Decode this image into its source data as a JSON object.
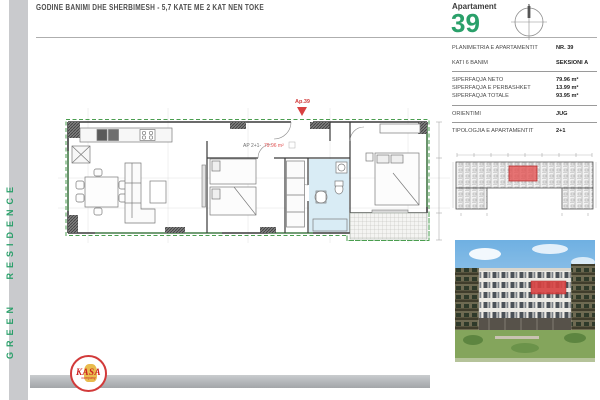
{
  "header": {
    "title": "GODINE BANIMI DHE SHERBIMESH - 5,7 KATE ME 2 KAT NEN TOKE"
  },
  "sidebar": {
    "brand": "GREEN RESIDENCE"
  },
  "apartment_card": {
    "label": "Apartament",
    "number": "39",
    "compass_north": "N"
  },
  "info_panel": {
    "rows": [
      {
        "label": "PLANIMETRIA E APARTAMENTIT",
        "value": "NR. 39"
      },
      {
        "label": "KATI 6 BANIM",
        "value": "SEKSIONI A"
      }
    ],
    "areas": [
      {
        "label": "SIPERFAQJA NETO",
        "value": "79.96 m²"
      },
      {
        "label": "SIPERFAQJA E PERBASHKET",
        "value": "13.99 m²"
      },
      {
        "label": "SIPERFAQJA TOTALE",
        "value": "93.95 m²"
      }
    ],
    "orientation": {
      "label": "ORIENTIMI",
      "value": "JUG"
    },
    "typology": {
      "label": "TIPOLOGJIA E APARTAMENTIT",
      "value": "2+1"
    }
  },
  "floor_plan": {
    "entry_label": "Ap.39",
    "unit_label": "AP 2+1-",
    "unit_area": "79.96 m²"
  },
  "logo": {
    "name": "KASA",
    "subtitle": "company"
  },
  "colors": {
    "accent_green": "#2aa06a",
    "highlight_red": "#e25353",
    "bathroom_blue": "#d9ecf5",
    "sidebar_gray": "#c9cacd",
    "plan_green_line": "#4a9e4f"
  }
}
